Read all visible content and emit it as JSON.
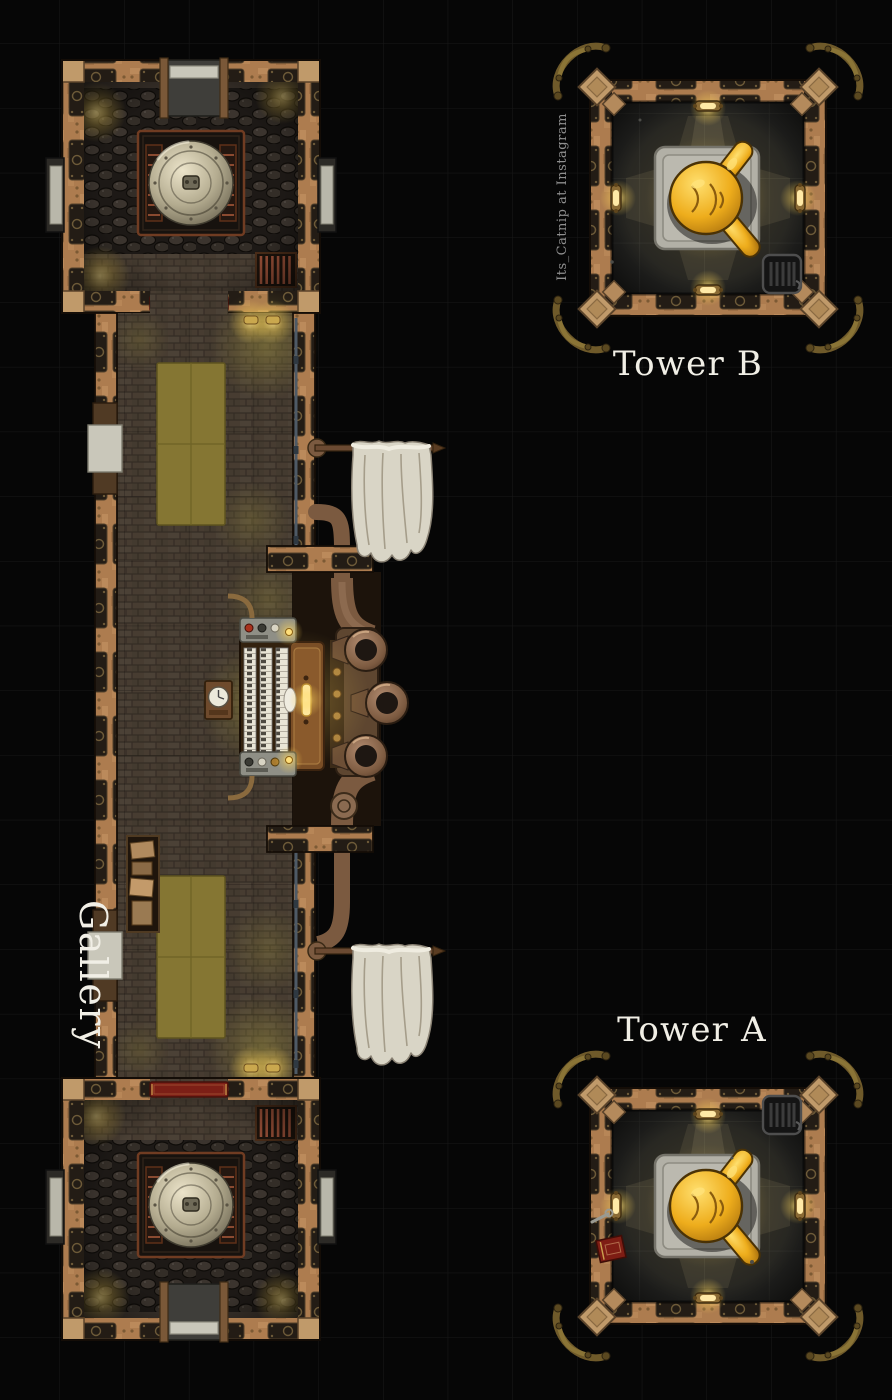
{
  "scene": {
    "map_labels": {
      "gallery": "Gallery",
      "tower_a": "Tower A",
      "tower_b": "Tower B"
    },
    "watermark": "Its_Catnip at Instagram",
    "areas": {
      "gallery": {
        "name": "Gallery",
        "rooms": [
          "north boiler room",
          "great hall",
          "south boiler room"
        ],
        "objects": [
          "steam boiler dome",
          "coal piles",
          "wall ladder",
          "red door carpet",
          "olive floor rug",
          "pipe organ with three horns",
          "wall clock",
          "storage shelf",
          "hanging cloth banners",
          "steam pipes",
          "stone side doors",
          "wall lamps"
        ]
      },
      "tower_b": {
        "name": "Tower B",
        "objects": [
          "gold statue on stone platform",
          "wall lamps",
          "radiator",
          "corner pipe ornaments"
        ]
      },
      "tower_a": {
        "name": "Tower A",
        "objects": [
          "gold statue on stone platform",
          "wall lamps",
          "radiator",
          "red book",
          "wrench",
          "corner pipe ornaments"
        ]
      }
    }
  },
  "theme": {
    "bg": "#060606",
    "grid": "#181818",
    "grid-light": "rgba(219,219,199,0.10)",
    "label": "#f1efe6",
    "watermark": "#8f8f8f",
    "wall": "#ad7c4f",
    "wall-panel": "#231c15",
    "stone": "#c9c7ba",
    "brick": "#473c31",
    "coal-bed": "#1d1916",
    "rug": "#857633",
    "carpet": "#7c1f16",
    "banner-cloth": "#d9d5c6",
    "pipe": "#7b5a40",
    "gold": "#eead1c",
    "glow": "#ffd659",
    "tower-floor": "#232321",
    "platform": "#b2b0a6",
    "dome": "#cfc7ae"
  }
}
